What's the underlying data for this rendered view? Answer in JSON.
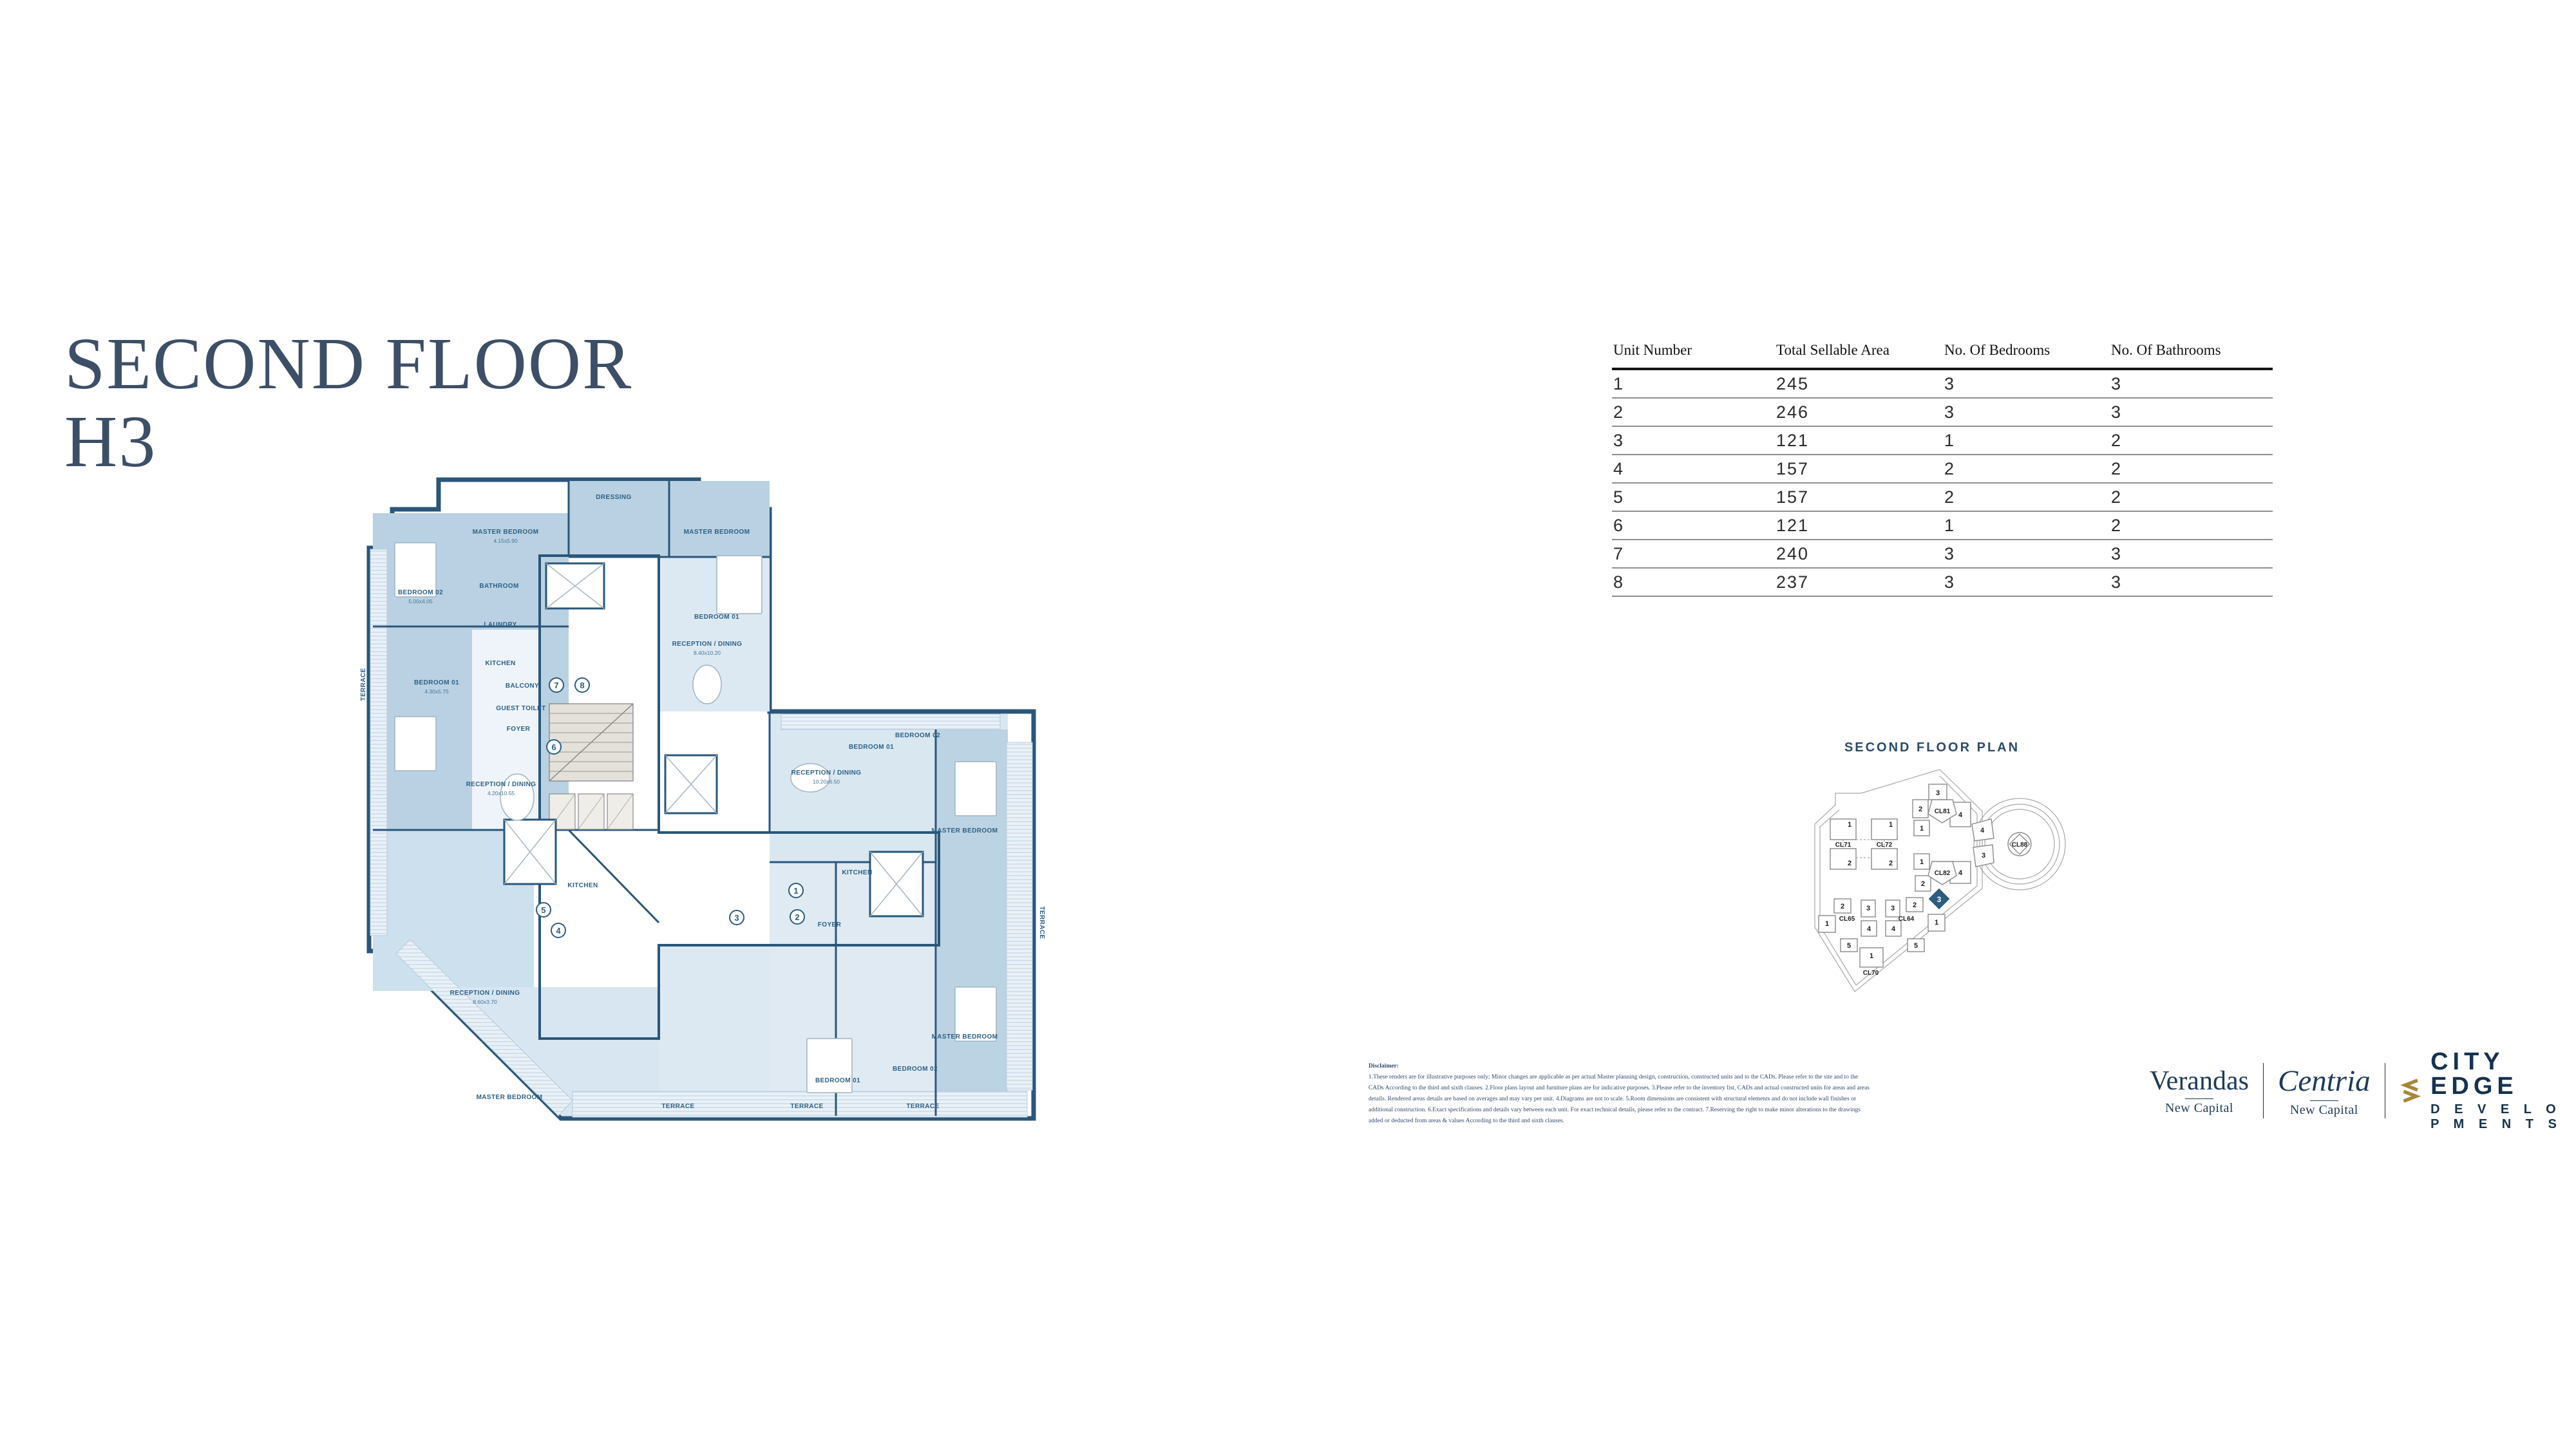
{
  "page": {
    "title_line1": "SECOND FLOOR",
    "title_line2": "H3"
  },
  "table": {
    "headers": [
      "Unit Number",
      "Total Sellable Area",
      "No. Of Bedrooms",
      "No. Of Bathrooms"
    ],
    "rows": [
      [
        "1",
        "245",
        "3",
        "3"
      ],
      [
        "2",
        "246",
        "3",
        "3"
      ],
      [
        "3",
        "121",
        "1",
        "2"
      ],
      [
        "4",
        "157",
        "2",
        "2"
      ],
      [
        "5",
        "157",
        "2",
        "2"
      ],
      [
        "6",
        "121",
        "1",
        "2"
      ],
      [
        "7",
        "240",
        "3",
        "3"
      ],
      [
        "8",
        "237",
        "3",
        "3"
      ]
    ]
  },
  "plan": {
    "unit_markers": [
      "1",
      "2",
      "3",
      "4",
      "5",
      "6",
      "7",
      "8"
    ],
    "labels": [
      "MASTER BEDROOM",
      "MASTER BEDROOM",
      "DRESSING",
      "BEDROOM 02",
      "BEDROOM 01",
      "TERRACE",
      "BATHROOM",
      "LAUNDRY",
      "KITCHEN",
      "BALCONY",
      "GUEST TOILET",
      "FOYER",
      "RECEPTION / DINING",
      "RECEPTION / DINING",
      "BEDROOM 01",
      "RECEPTION / DINING",
      "BEDROOM 01",
      "BEDROOM 02",
      "MASTER BEDROOM",
      "KITCHEN",
      "FOYER",
      "MASTER BEDROOM",
      "BEDROOM 01",
      "BEDROOM 02",
      "RECEPTION / DINING",
      "MASTER BEDROOM",
      "KITCHEN",
      "TERRACE",
      "TERRACE",
      "TERRACE",
      "TERRACE"
    ],
    "dims": [
      "4.15x5.90",
      "5.00x4.05",
      "4.30x5.75",
      "4.20x10.55",
      "8.40x10.20",
      "10.20x6.50",
      "8.60x3.70"
    ]
  },
  "mini_plan": {
    "title": "SECOND FLOOR PLAN",
    "clusters": [
      "CL71",
      "CL72",
      "CL81",
      "CL82",
      "CL65",
      "CL64",
      "CL70",
      "CL88"
    ],
    "cl7172_units": [
      "1",
      "1",
      "2",
      "2"
    ],
    "cl81_units": [
      "3",
      "2",
      "1",
      "4"
    ],
    "cl82_units": [
      "1",
      "2",
      "4"
    ],
    "wedge_units": [
      "4",
      "3"
    ],
    "cl65_units": [
      "2",
      "3",
      "1",
      "4",
      "5"
    ],
    "cl64_units": [
      "3",
      "2",
      "1",
      "4",
      "5"
    ],
    "cl70_units": [
      "1"
    ],
    "highlight_unit": "3"
  },
  "disclaimer": {
    "heading": "Disclaimer:",
    "lines": [
      "1.These renders are for illustrative purposes only; Minor changes are applicable as per actual Master planning design, construction, constructed units and to the CADs. Please refer to the site and to the",
      "CADs According to the third and sixth clauses. 2.Floor plans layout and furniture plans are for indicative purposes. 3.Please refer to the inventory list, CADs and actual constructed units for areas and areas",
      "details. Rendered areas details are based on averages and may vary per unit. 4.Diagrams are not to scale. 5.Room dimensions are consistent with structural elements and do not include wall finishes or",
      "additional construction. 6.Exact specifications and details vary between each unit. For exact technical details, please refer to the contract. 7.Reserving the right to make minor alterations to the drawings",
      "added or deducted from areas & values According to the third and sixth clauses."
    ]
  },
  "logos": {
    "verandas": {
      "name": "Verandas",
      "tagline": "New Capital"
    },
    "centria": {
      "name": "Centria",
      "tagline": "New Capital"
    },
    "cityedge": {
      "line1": "CITY EDGE",
      "line2": "D E V E L O P M E N T S"
    }
  },
  "colors": {
    "title": "#3d4f66",
    "wall": "#2a5679",
    "room_medium": "#b9d1e2",
    "room_pale": "#dce8f2",
    "core_gray": "#d8d5ce",
    "terrace": "#e9f1f7",
    "highlight": "#2c5d7e",
    "logo_navy": "#1d3b5c",
    "logo_gold": "#a6873c"
  }
}
